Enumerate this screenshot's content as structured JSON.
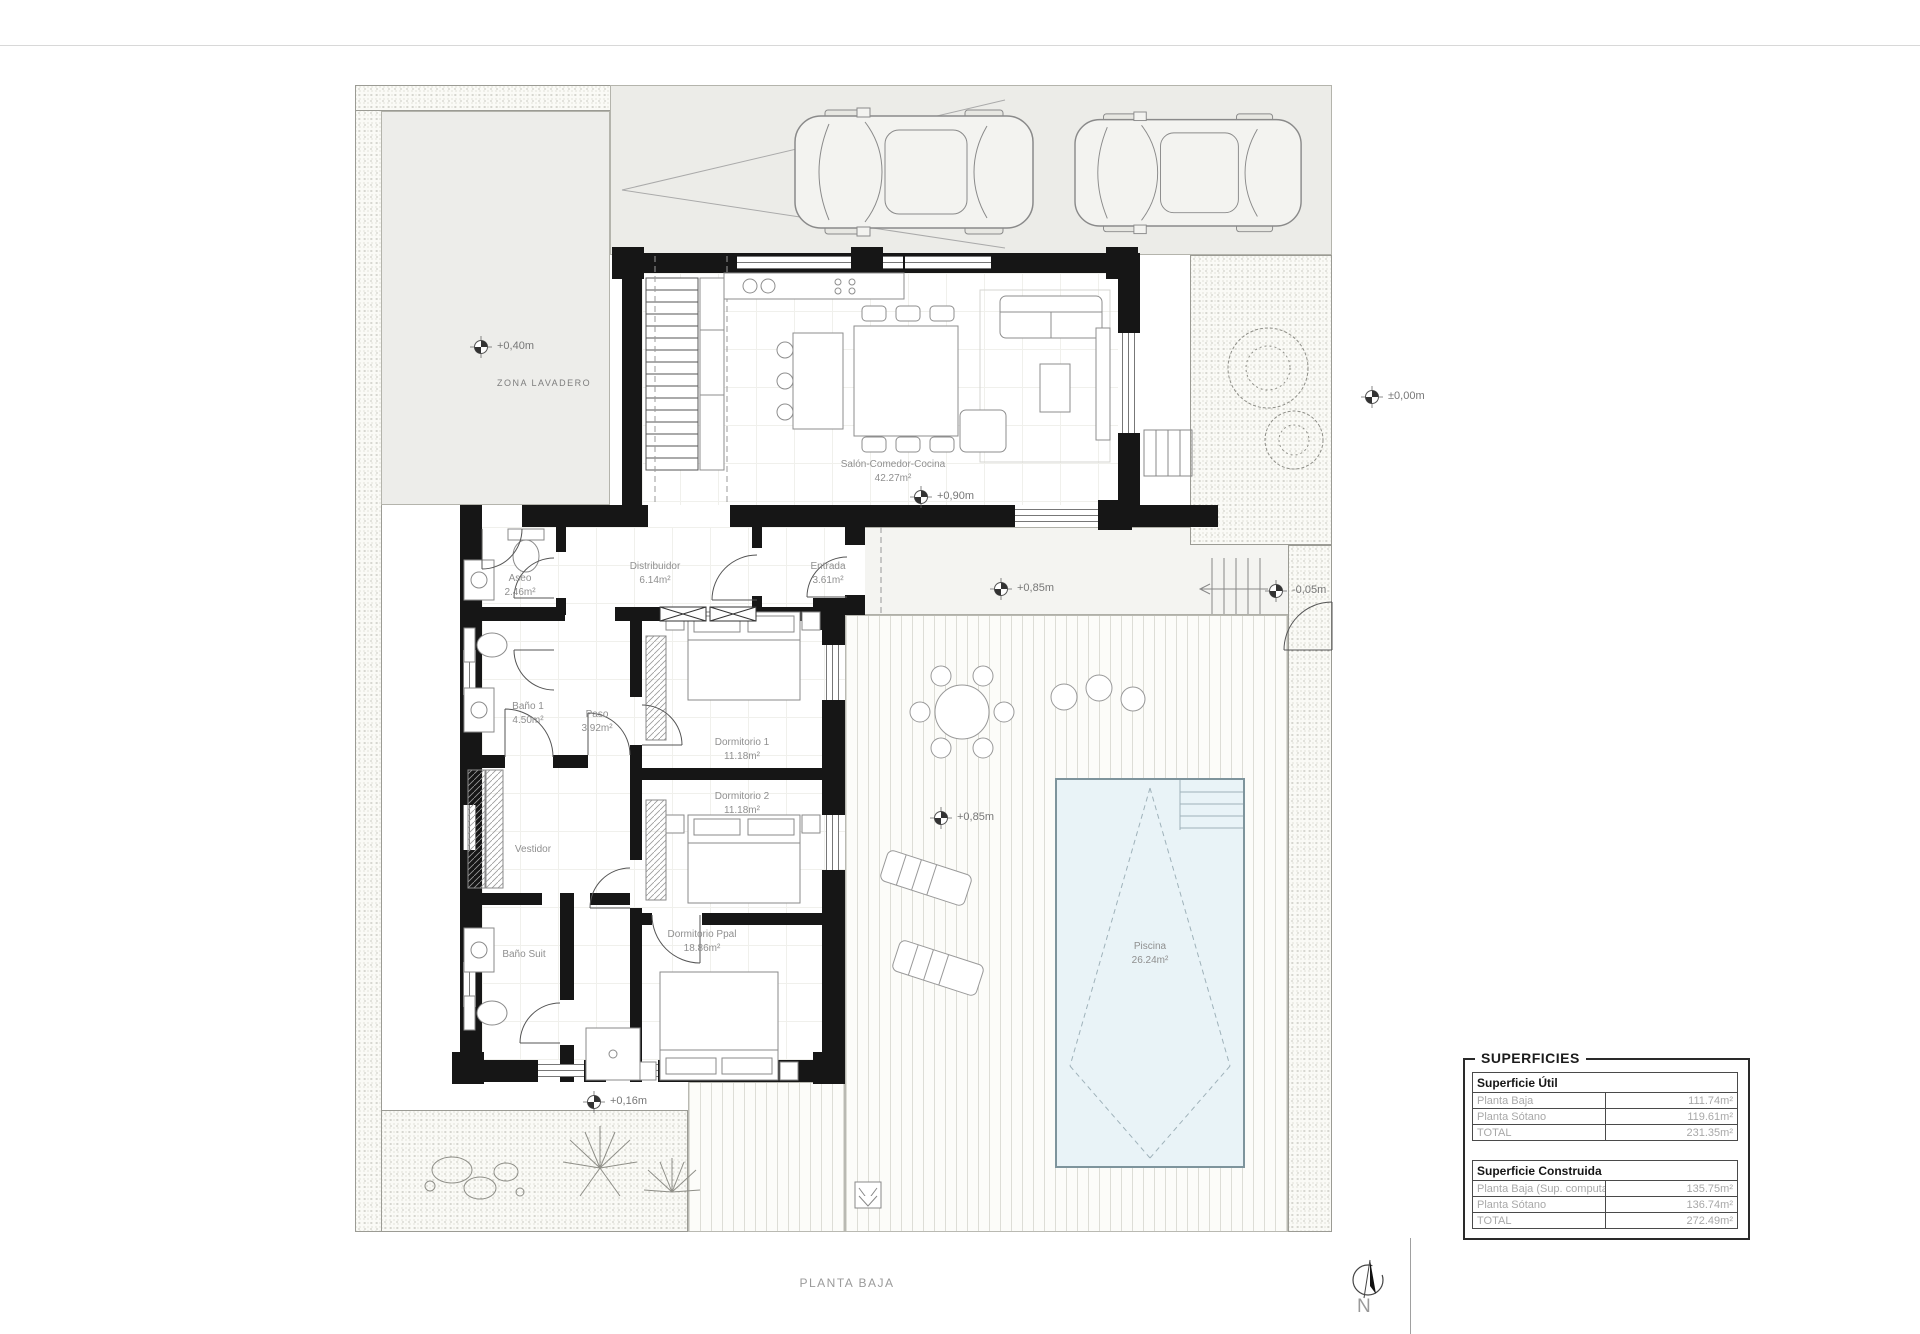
{
  "sheet": {
    "footer_title": "PLANTA BAJA",
    "compass_label": "N"
  },
  "zones": {
    "lavadero": "ZONA LAVADERO"
  },
  "rooms": {
    "salon": {
      "name": "Salón-Comedor-Cocina",
      "area": "42.27m²"
    },
    "distribuidor": {
      "name": "Distribuidor",
      "area": "6.14m²"
    },
    "entrada": {
      "name": "Entrada",
      "area": "3.61m²"
    },
    "aseo": {
      "name": "Aseo",
      "area": "2.46m²"
    },
    "bano1": {
      "name": "Baño 1",
      "area": "4.50m²"
    },
    "paso": {
      "name": "Paso",
      "area": "3.92m²"
    },
    "dormitorio1": {
      "name": "Dormitorio 1",
      "area": "11.18m²"
    },
    "dormitorio2": {
      "name": "Dormitorio 2",
      "area": "11.18m²"
    },
    "vestidor": {
      "name": "Vestidor"
    },
    "bano_suit": {
      "name": "Baño Suit"
    },
    "dormitorio_ppal": {
      "name": "Dormitorio Ppal",
      "area": "18.86m²"
    },
    "piscina": {
      "name": "Piscina",
      "area": "26.24m²"
    }
  },
  "levels": {
    "lavadero": "+0,40m",
    "street": "±0,00m",
    "salon": "+0,90m",
    "walkway": "+0,85m",
    "street_step": "-0,05m",
    "deck": "+0,85m",
    "south": "+0,16m"
  },
  "areas_table": {
    "title": "SUPERFICIES",
    "sections": [
      {
        "header": "Superficie Útil",
        "rows": [
          {
            "label": "Planta Baja",
            "value": "111.74m²"
          },
          {
            "label": "Planta Sótano",
            "value": "119.61m²"
          },
          {
            "label": "TOTAL",
            "value": "231.35m²"
          }
        ]
      },
      {
        "header": "Superficie Construida",
        "rows": [
          {
            "label": "Planta Baja (Sup. computable)",
            "value": "135.75m²"
          },
          {
            "label": "Planta Sótano",
            "value": "136.74m²"
          },
          {
            "label": "TOTAL",
            "value": "272.49m²"
          }
        ]
      }
    ]
  }
}
